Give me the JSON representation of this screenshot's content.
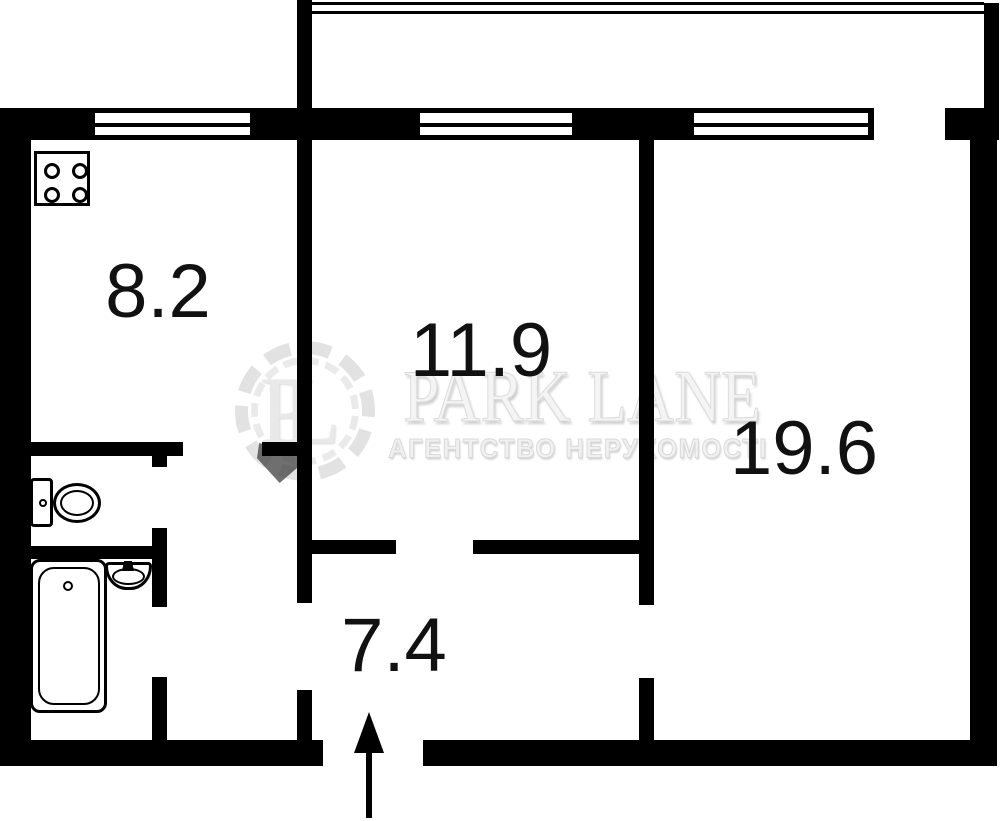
{
  "document": {
    "type": "apartment floor plan"
  },
  "rooms": [
    {
      "name": "kitchen",
      "area_label": "8.2"
    },
    {
      "name": "bedroom",
      "area_label": "11.9"
    },
    {
      "name": "living-room",
      "area_label": "19.6"
    },
    {
      "name": "hallway",
      "area_label": "7.4"
    }
  ],
  "watermark": {
    "monogram": "PL",
    "brand": "PARK LANE",
    "tagline": "АГЕНТСТВО НЕРУХОМОСТІ"
  },
  "icons": {
    "stove": "four-burner-stove",
    "toilet": "toilet-tank-and-bowl",
    "bathtub": "bathtub-with-drain",
    "sink": "wash-basin-with-tap",
    "entry": "entrance-arrow-up",
    "balcony": "double-railing-lines",
    "window": "double-line-window"
  },
  "colors": {
    "walls": "#000000",
    "background": "#ffffff",
    "labels": "#111111",
    "watermark_light": "#e9e9e9",
    "watermark_dark": "#474747"
  }
}
